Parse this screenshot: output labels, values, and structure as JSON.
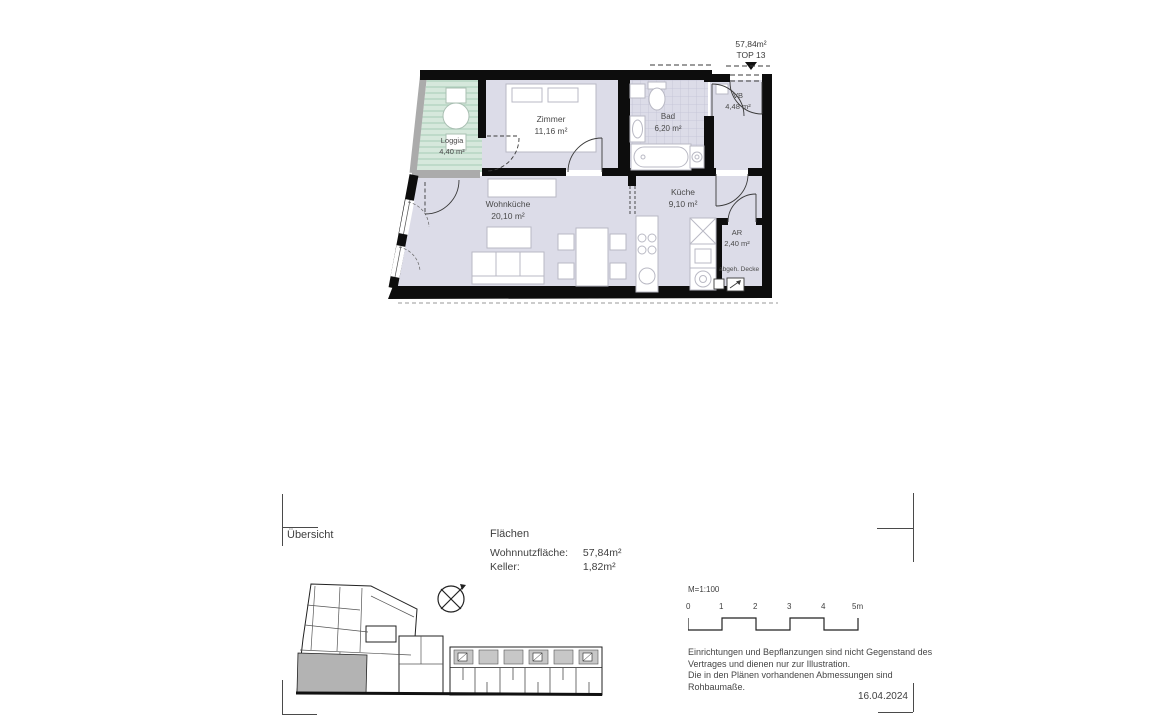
{
  "plan": {
    "marker": {
      "area": "57,84m²",
      "unit": "TOP 13"
    },
    "rooms": [
      {
        "name": "Loggia",
        "area": "4,40 m²"
      },
      {
        "name": "Zimmer",
        "area": "11,16 m²"
      },
      {
        "name": "Bad",
        "area": "6,20 m²"
      },
      {
        "name": "VB",
        "area": "4,48 m²"
      },
      {
        "name": "Wohnküche",
        "area": "20,10 m²"
      },
      {
        "name": "Küche",
        "area": "9,10 m²"
      },
      {
        "name": "AR",
        "area": "2,40 m²"
      }
    ],
    "note_ceiling": "abgeh. Decke",
    "colors": {
      "room_fill": "#dcdce8",
      "loggia_fill": "#d6e8dc",
      "loggia_stripe": "#aecfbc",
      "tile_line": "#c2c2d6",
      "wall": "#0d0d0d",
      "slab": "#ababab",
      "site_highlight": "#b3b3b3"
    }
  },
  "footer": {
    "overview_label": "Übersicht",
    "areas": {
      "title": "Flächen",
      "rows": [
        {
          "label": "Wohnnutzfläche:",
          "value": "57,84m²"
        },
        {
          "label": "Keller:",
          "value": "1,82m²"
        }
      ]
    },
    "scale": {
      "label": "M=1:100",
      "ticks": [
        "0",
        "1",
        "2",
        "3",
        "4",
        "5m"
      ]
    },
    "disclaimer_lines": [
      "Einrichtungen und Bepflanzungen sind nicht Gegenstand des",
      "Vertrages und dienen nur zur Illustration.",
      "Die in den Plänen vorhandenen Abmessungen sind",
      "Rohbaumaße."
    ],
    "date": "16.04.2024"
  }
}
